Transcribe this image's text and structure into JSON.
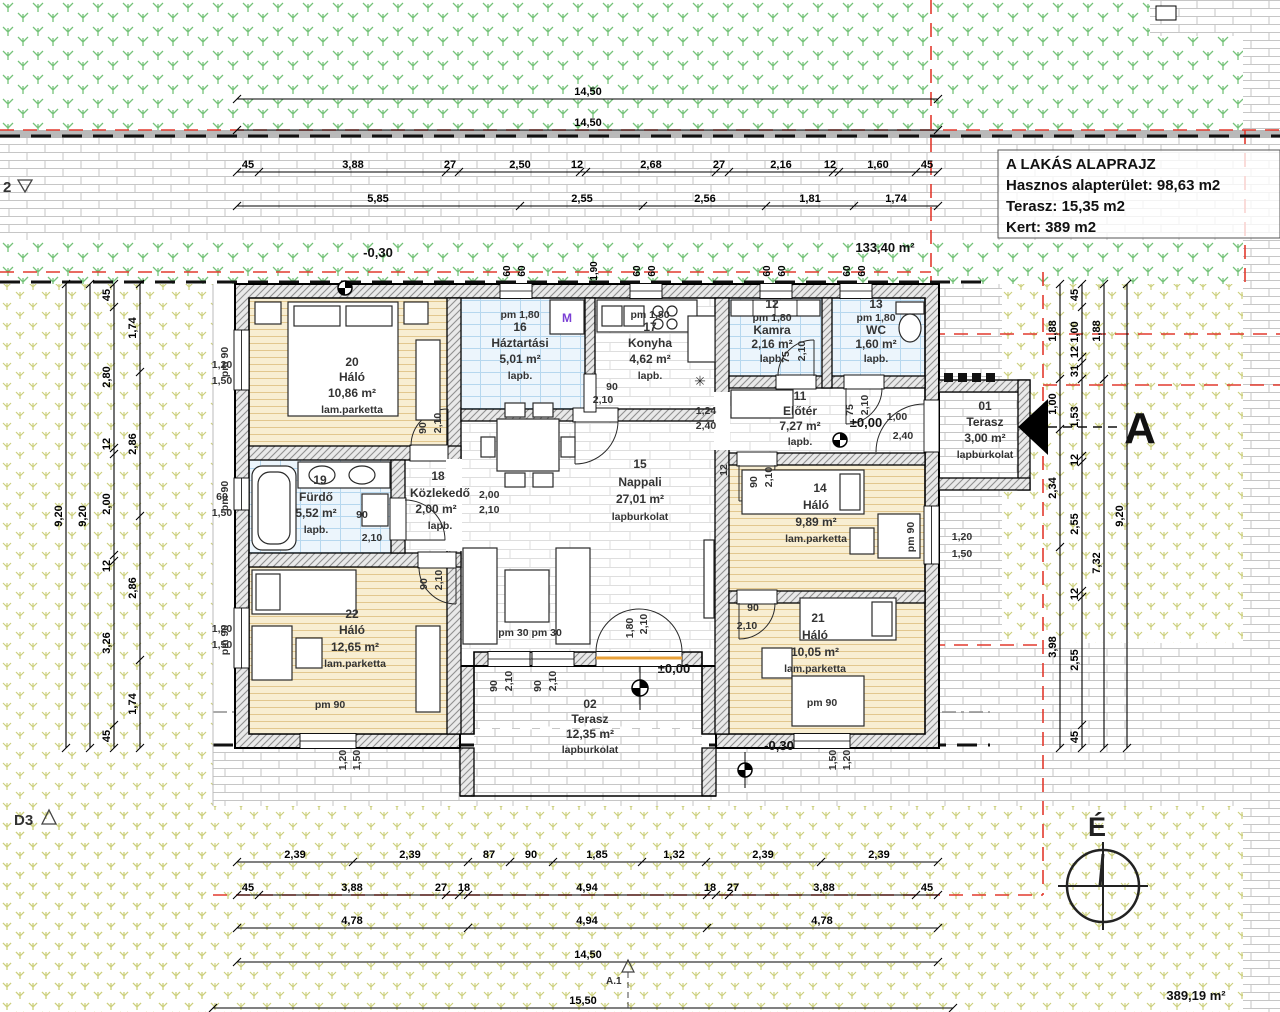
{
  "title_block": {
    "title": "A LAKÁS ALAPRAJZ",
    "line2": "Hasznos alapterület: 98,63 m2",
    "line3": "Terasz:  15,35 m2",
    "line4": "Kert: 389 m2"
  },
  "rooms": {
    "halo20": {
      "num": "20",
      "name": "Háló",
      "area": "10,86 m²",
      "floor": "lam.parketta"
    },
    "haztartasi": {
      "num": "16",
      "name": "Háztartási",
      "area": "5,01 m²",
      "floor": "lapb.",
      "window": "pm 1,80"
    },
    "konyha": {
      "num": "17",
      "name": "Konyha",
      "area": "4,62 m²",
      "floor": "lapb.",
      "window": "pm 1,80"
    },
    "kamra": {
      "num": "12",
      "name": "Kamra",
      "area": "2,16 m²",
      "floor": "lapb.",
      "window": "pm 1,80"
    },
    "wc": {
      "num": "13",
      "name": "WC",
      "area": "1,60 m²",
      "floor": "lapb.",
      "window": "pm 1,80"
    },
    "eloter": {
      "num": "11",
      "name": "Előtér",
      "area": "7,27 m²",
      "floor": "lapb."
    },
    "furdo": {
      "num": "19",
      "name": "Fürdő",
      "area": "5,52 m²",
      "floor": "lapb."
    },
    "kozlekedo": {
      "num": "18",
      "name": "Közlekedő",
      "area": "2,00 m²",
      "floor": "lapb."
    },
    "nappali": {
      "num": "15",
      "name": "Nappali",
      "area": "27,01 m²",
      "floor": "lapburkolat"
    },
    "halo14": {
      "num": "14",
      "name": "Háló",
      "area": "9,89 m²",
      "floor": "lam.parketta"
    },
    "halo21": {
      "num": "21",
      "name": "Háló",
      "area": "10,05 m²",
      "floor": "lam.parketta"
    },
    "halo22": {
      "num": "22",
      "name": "Háló",
      "area": "12,65 m²",
      "floor": "lam.parketta"
    },
    "terasz01": {
      "num": "01",
      "name": "Terasz",
      "area": "3,00 m²",
      "floor": "lapburkolat"
    },
    "terasz02": {
      "num": "02",
      "name": "Terasz",
      "area": "12,35 m²",
      "floor": "lapburkolat"
    }
  },
  "dims": {
    "top_row1": [
      "14,50"
    ],
    "top_row2": [
      "14,50"
    ],
    "top_row3": [
      "45",
      "3,88",
      "27",
      "2,50",
      "12",
      "2,68",
      "27",
      "2,16",
      "12",
      "1,60",
      "45"
    ],
    "top_row4": [
      "5,85",
      "2,55",
      "2,56",
      "1,81",
      "1,74"
    ],
    "bottom_row1": [
      "2,39",
      "2,39",
      "87",
      "90",
      "1,85",
      "1,32",
      "2,39",
      "2,39"
    ],
    "bottom_row2": [
      "45",
      "3,88",
      "27",
      "18",
      "4,94",
      "18",
      "27",
      "3,88",
      "45"
    ],
    "bottom_row3": [
      "4,78",
      "4,94",
      "4,78"
    ],
    "bottom_row4": [
      "14,50"
    ],
    "bottom_row5": [
      "15,50"
    ],
    "left_out1": [
      "9,20"
    ],
    "left_out2": [
      "9,20"
    ],
    "left_row3": [
      "45",
      "2,80",
      "12",
      "2,00",
      "12",
      "3,26",
      "45"
    ],
    "left_row4": [
      "1,74",
      "2,86",
      "2,86",
      "1,74"
    ],
    "right_row1": [
      "1,88",
      "1,00",
      "2,34",
      "3,98"
    ],
    "right_row2": [
      "45",
      "1,00",
      "12",
      "31",
      "1,53",
      "12",
      "2,55",
      "12",
      "2,55",
      "45"
    ],
    "right_row3": [
      "1,88",
      "7,32"
    ],
    "right_out": [
      "9,20"
    ],
    "top_wall": [
      "60",
      "60",
      "1,90",
      "60",
      "60",
      "60",
      "60",
      "60",
      "60"
    ]
  },
  "labels": {
    "pm90": "pm 90",
    "pm180": "pm 1,80",
    "pm3030": "pm 30 pm 30",
    "d90": "90",
    "d210": "2,10",
    "d75": "75",
    "d100": "1,00",
    "d240": "2,40",
    "d124": "1,24",
    "d120": "1,20",
    "d150": "1,50",
    "d60": "60",
    "d180": "1,80",
    "d200": "2,00",
    "d12": "12",
    "m": "M",
    "boiler": "✳"
  },
  "annotations": {
    "level_top": "-0,30",
    "area_covered": "133,40 m²",
    "level_entry": "±0,00",
    "level_terrace": "±0,00",
    "level_front": "-0,30",
    "plot_area": "389,19 m²",
    "north": "É",
    "section": "A",
    "marker_left": "2",
    "marker_d3": "D3",
    "marker_a1": "A.1"
  },
  "colors": {
    "plant_green": "#76c37a",
    "plant_yellow": "#cdd07e",
    "wall_hatch": "#909090",
    "parquet": "#f8eed2",
    "tile_blue": "#ecf5fc",
    "red_line": "#e23a2e",
    "accent_orange": "#e8a13a"
  }
}
